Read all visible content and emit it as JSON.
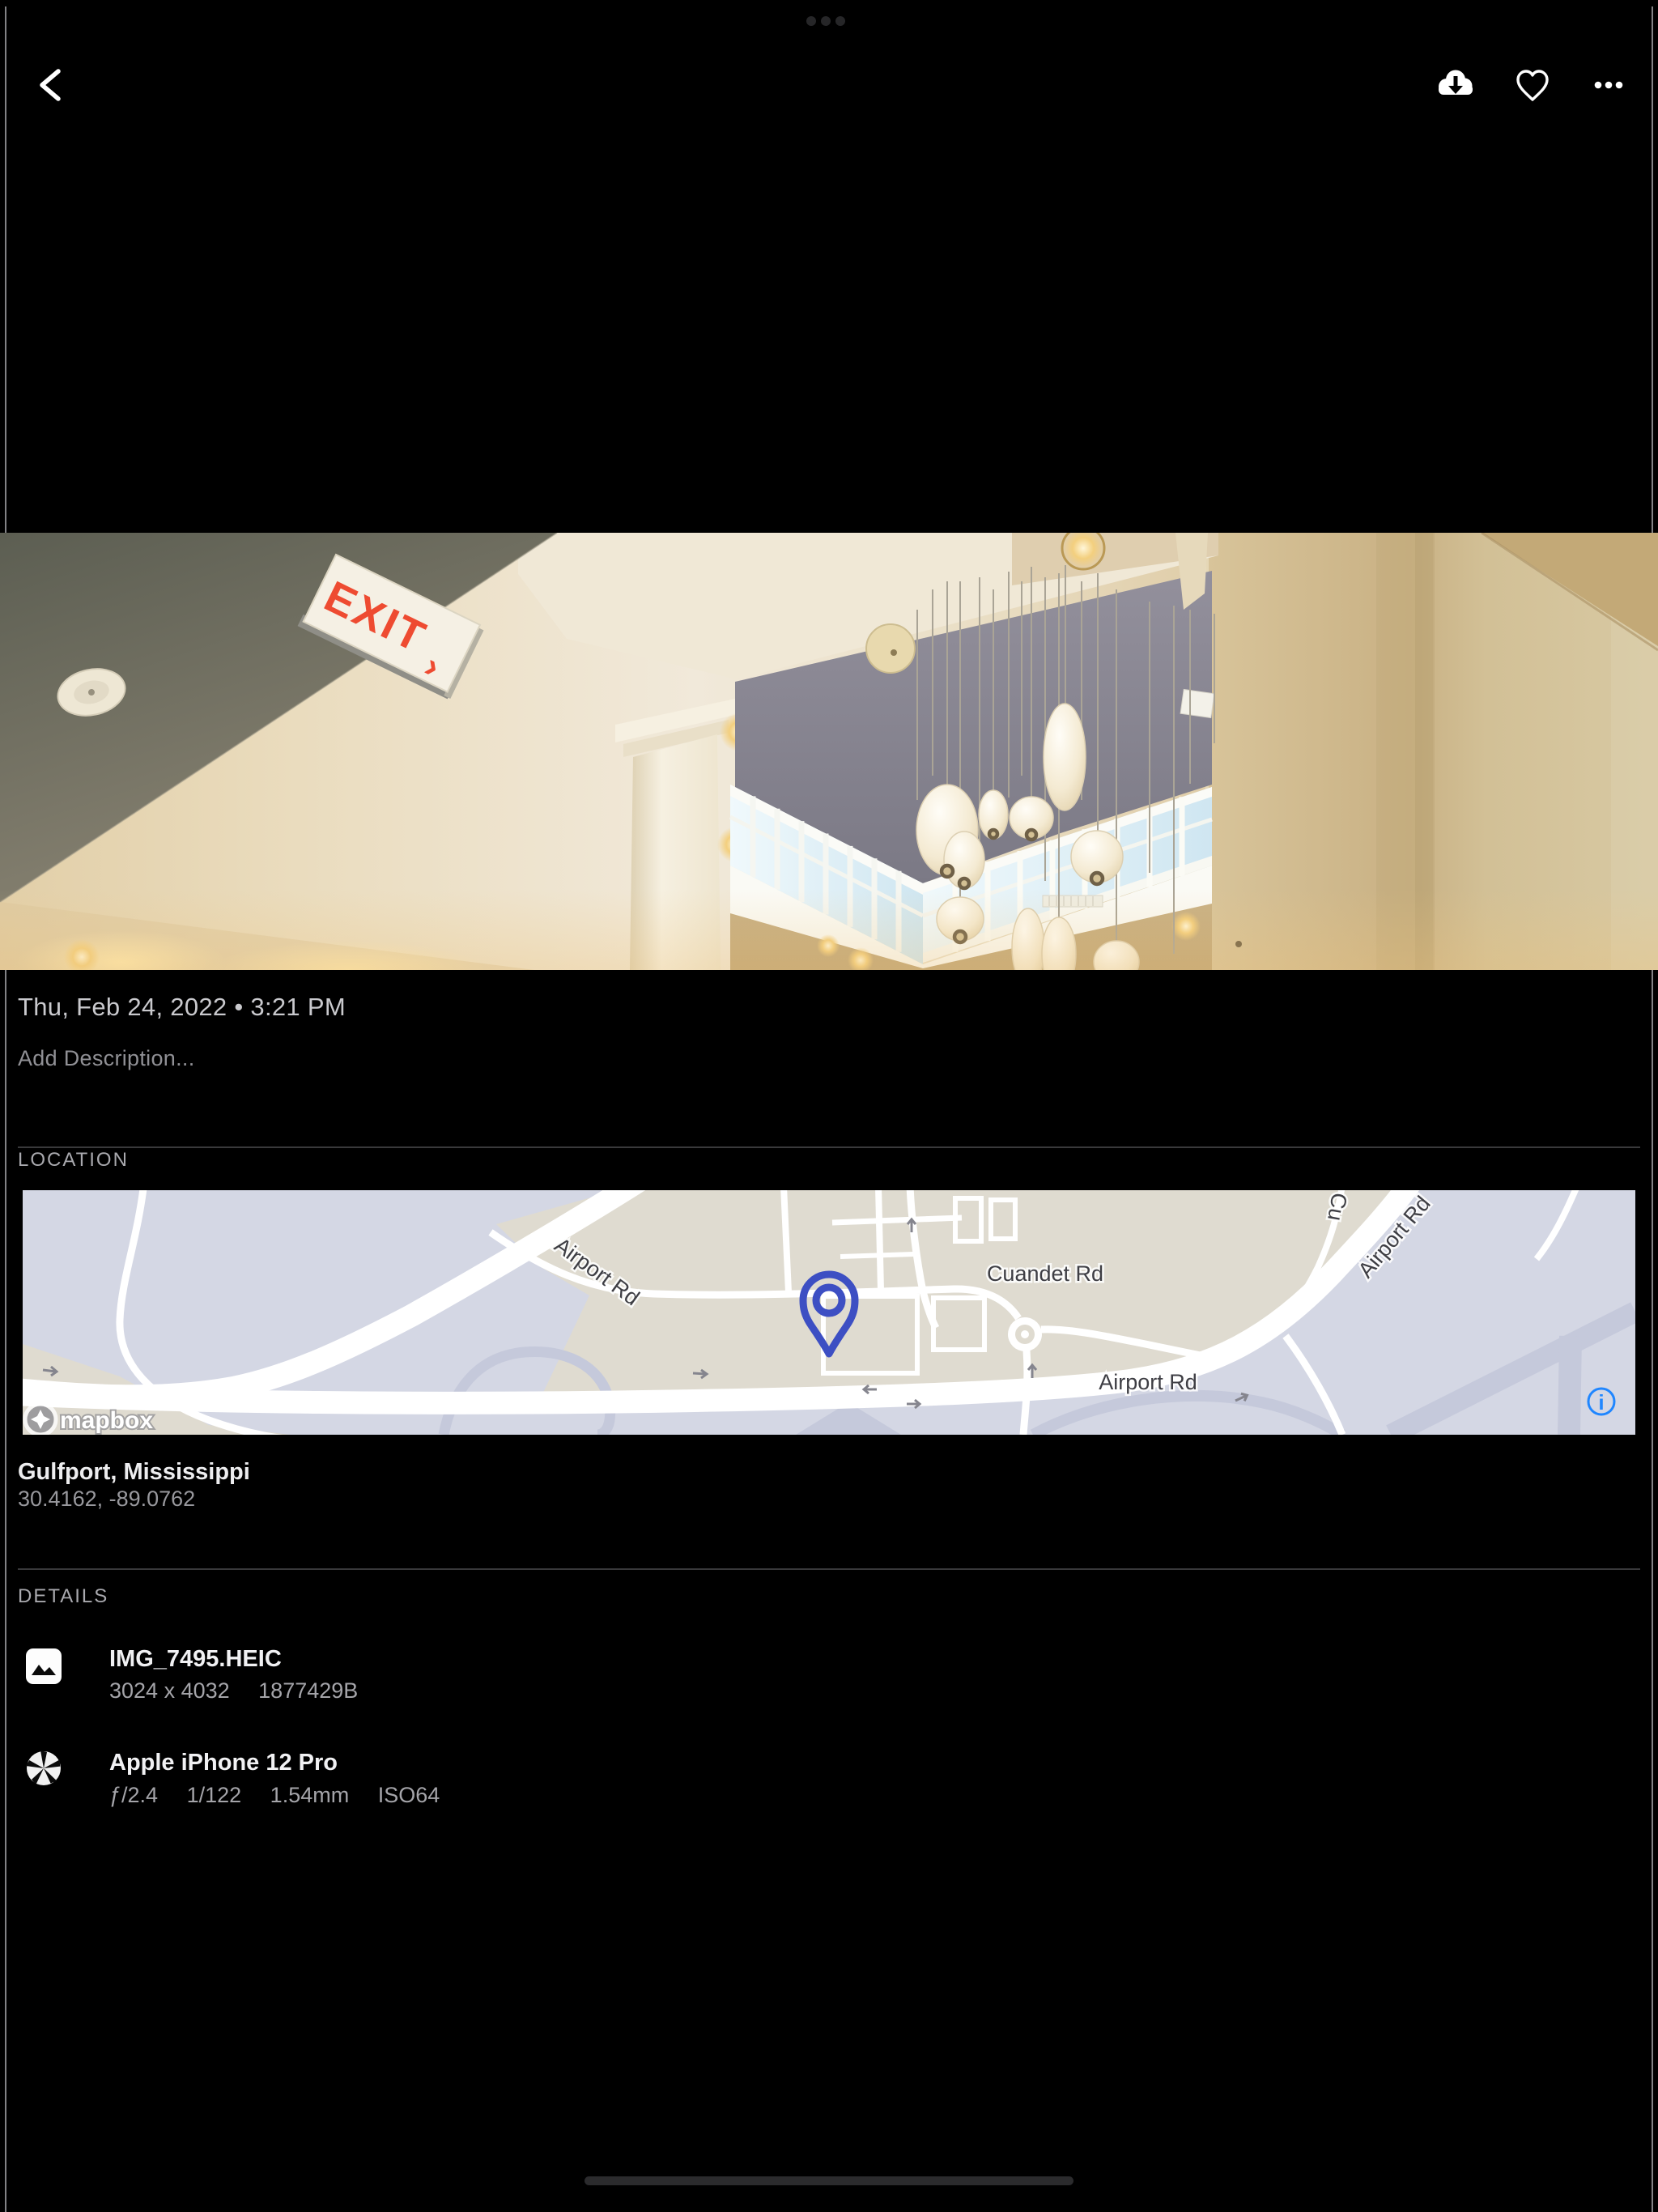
{
  "toolbar": {},
  "photo": {
    "exit_text": "EXIT",
    "exit_arrow": "›"
  },
  "info": {
    "datetime": "Thu, Feb 24, 2022 • 3:21 PM",
    "description_placeholder": "Add Description..."
  },
  "location": {
    "header": "LOCATION",
    "place": "Gulfport, Mississippi",
    "coordinates": "30.4162, -89.0762",
    "map": {
      "labels": {
        "airport_rd_left": "Airport Rd",
        "cuandet_rd": "Cuandet Rd",
        "airport_rd_bottom": "Airport Rd",
        "airport_rd_upper_right": "Airport Rd",
        "cuandet_partial": "Cu"
      },
      "attribution": "mapbox",
      "info_glyph": "i",
      "pin_color": "#3D4FC3",
      "accent_blue": "#1F86FF"
    }
  },
  "details": {
    "header": "DETAILS",
    "items": [
      {
        "title": "IMG_7495.HEIC",
        "subtitle_parts": [
          "3024 x 4032",
          "1877429B"
        ]
      },
      {
        "title": "Apple iPhone 12 Pro",
        "subtitle_parts": [
          "ƒ/2.4",
          "1/122",
          "1.54mm",
          "ISO64"
        ]
      }
    ]
  }
}
